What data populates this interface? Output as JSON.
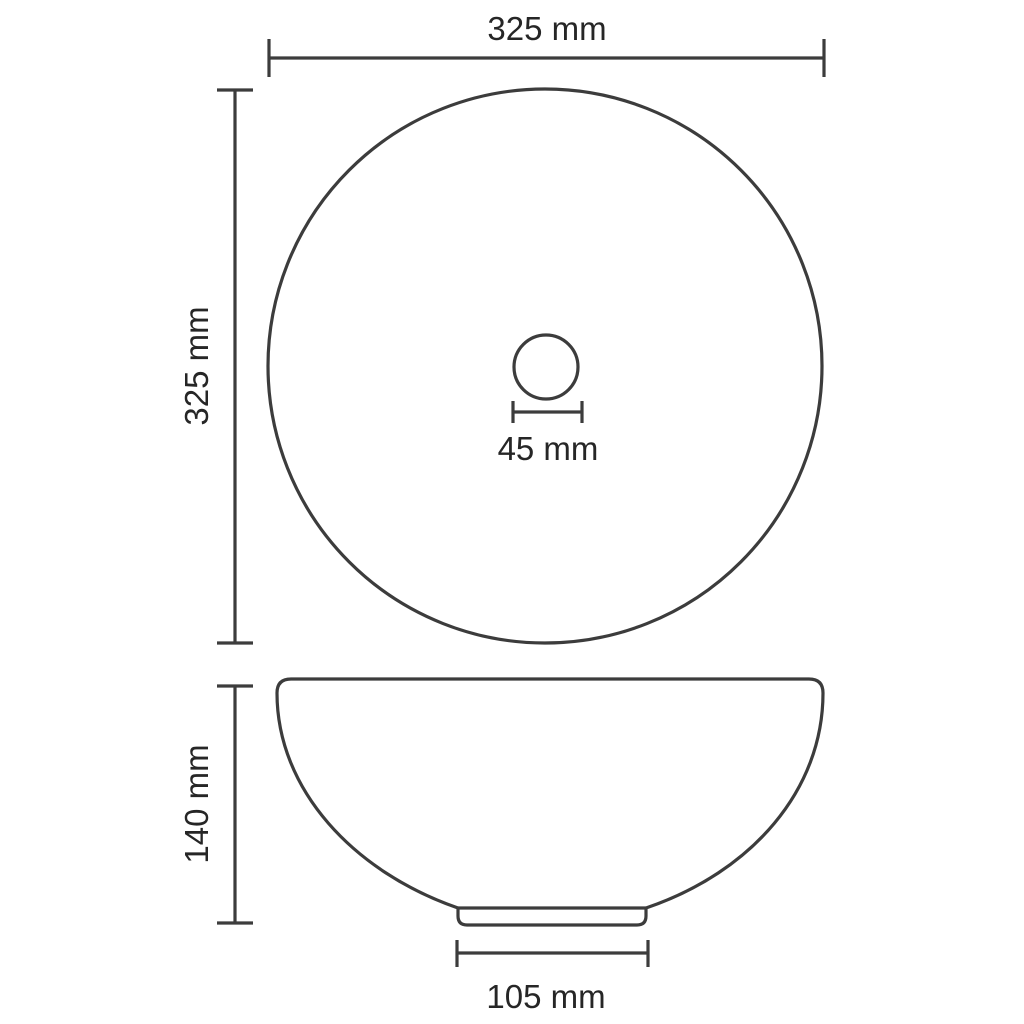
{
  "diagram": {
    "type": "technical-dimension-drawing",
    "subject": "round-countertop-basin",
    "views": {
      "top_view": "basin outer rim circle with center drain hole",
      "side_view": "bowl profile with pedestal base"
    },
    "dimensions": {
      "top_width": {
        "label": "325 mm",
        "value_mm": 325,
        "orientation": "horizontal",
        "measures": "outer diameter (width), top view"
      },
      "left_height": {
        "label": "325 mm",
        "value_mm": 325,
        "orientation": "vertical",
        "measures": "outer diameter (depth), top view"
      },
      "drain": {
        "label": "45 mm",
        "value_mm": 45,
        "orientation": "horizontal",
        "measures": "drain hole diameter"
      },
      "side_height": {
        "label": "140 mm",
        "value_mm": 140,
        "orientation": "vertical",
        "measures": "basin height, side view"
      },
      "base_width": {
        "label": "105 mm",
        "value_mm": 105,
        "orientation": "horizontal",
        "measures": "pedestal base width"
      }
    }
  },
  "colors": {
    "line": "#3c3c3c",
    "text": "#262626",
    "background": "#ffffff"
  }
}
